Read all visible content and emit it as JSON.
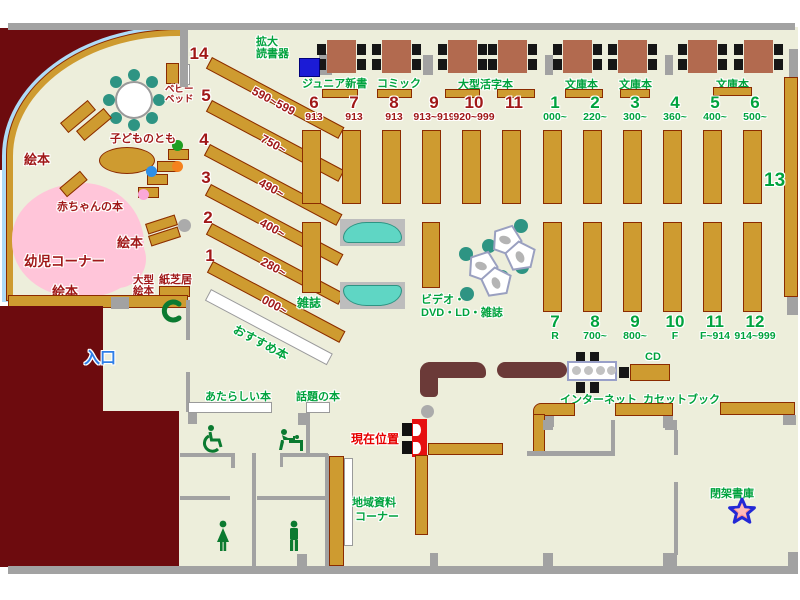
{
  "top": {
    "kakudai": {
      "line1": "拡大",
      "line2": "読書器"
    },
    "junior": "ジュニア新書",
    "comic": "コミック",
    "large_print": "大型活字本",
    "bunko1": "文庫本",
    "bunko2": "文庫本",
    "bunko3": "文庫本"
  },
  "children": {
    "baby_bed": {
      "line1": "ベビー",
      "line2": "ベッド"
    },
    "kodomo_no_tomo": "子どものとも",
    "ehon_left": "絵本",
    "ehon_mid": "絵本",
    "ehon_bottom": "絵本",
    "akachan_books": "赤ちゃんの本",
    "youji_corner": "幼児コーナー",
    "ogata_ehon": {
      "line1": "大型",
      "line2": "絵本"
    },
    "kamishibai": "紙芝居",
    "phone": "C"
  },
  "shelves": {
    "diagonal": [
      {
        "no": "14",
        "range": "590~599"
      },
      {
        "no": "5",
        "range": "750~"
      },
      {
        "no": "4",
        "range": "490~"
      },
      {
        "no": "3",
        "range": "400~"
      },
      {
        "no": "2",
        "range": "280~"
      },
      {
        "no": "1",
        "range": "000~"
      }
    ],
    "red": [
      {
        "no": "6",
        "range": "913"
      },
      {
        "no": "7",
        "range": "913"
      },
      {
        "no": "8",
        "range": "913"
      },
      {
        "no": "9",
        "range": "913~919"
      },
      {
        "no": "10",
        "range": "920~999"
      },
      {
        "no": "11",
        "range": ""
      }
    ],
    "green_top": [
      {
        "no": "1",
        "range": "000~"
      },
      {
        "no": "2",
        "range": "220~"
      },
      {
        "no": "3",
        "range": "300~"
      },
      {
        "no": "4",
        "range": "360~"
      },
      {
        "no": "5",
        "range": "400~"
      },
      {
        "no": "6",
        "range": "500~"
      }
    ],
    "green_bottom": [
      {
        "no": "7",
        "range": "R"
      },
      {
        "no": "8",
        "range": "700~"
      },
      {
        "no": "9",
        "range": "800~"
      },
      {
        "no": "10",
        "range": "F"
      },
      {
        "no": "11",
        "range": "F~914"
      },
      {
        "no": "12",
        "range": "914~999"
      }
    ],
    "no13": "13",
    "osusume": "おすすめ本",
    "zasshi": "雑誌",
    "video_line1": "ビデオ・",
    "video_line2": "DVD・LD・雑誌"
  },
  "center": {
    "entrance": "入口",
    "atarashii": "あたらしい本",
    "wadai": "話題の本",
    "genzai": "現在位置",
    "chiiki": {
      "line1": "地域資料",
      "line2": "コーナー"
    }
  },
  "av": {
    "internet": "インターネット",
    "cd": "CD",
    "cassette": "カセットブック"
  },
  "heika": "閉架書庫"
}
